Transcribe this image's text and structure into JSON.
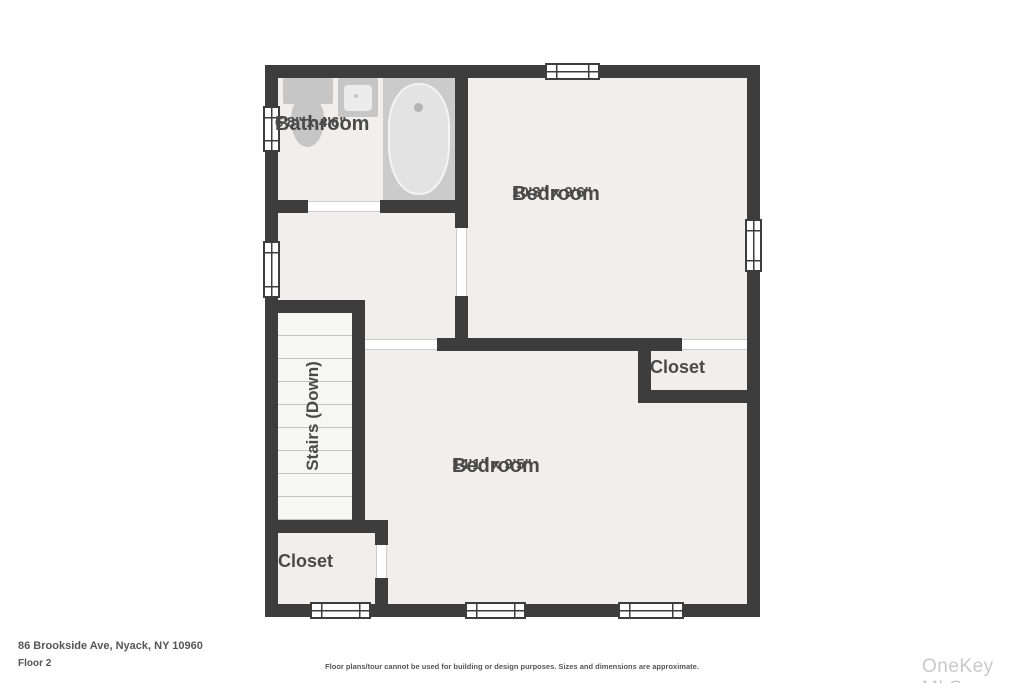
{
  "colors": {
    "page": "#ffffff",
    "wall": "#3d3d3d",
    "floor": "#f0efed",
    "fixture": "#c6c6c6",
    "tub-alcove": "#cbcbcb",
    "tub": "#e3e3e3",
    "stair-floor": "#f6f6f5",
    "stair-line": "#c3c3c3",
    "threshold-edge": "#cccccc",
    "label": "#4a4a4a",
    "footer-text": "#565656",
    "watermark": "#c9c9c9"
  },
  "rooms": {
    "bathroom": {
      "name": "Bathroom",
      "dims": "6'8\" x 4'6\""
    },
    "bedroom_top": {
      "name": "Bedroom",
      "dims": "10'3\" x 9'6\""
    },
    "bedroom_bottom": {
      "name": "Bedroom",
      "dims": "14'1\" x 9'5\""
    },
    "closet_right": {
      "name": "Closet"
    },
    "closet_left": {
      "name": "Closet"
    },
    "stairs": {
      "name": "Stairs (Down)"
    }
  },
  "fixtures": {
    "bathtub": "bathtub-icon",
    "toilet": "toilet-icon",
    "sink": "sink-icon"
  },
  "footer": {
    "address": "86 Brookside Ave, Nyack, NY 10960",
    "floor_label": "Floor 2",
    "disclaimer": "Floor plans/tour cannot be used for building or design purposes. Sizes and dimensions are approximate.",
    "watermark": "OneKey MLS"
  }
}
